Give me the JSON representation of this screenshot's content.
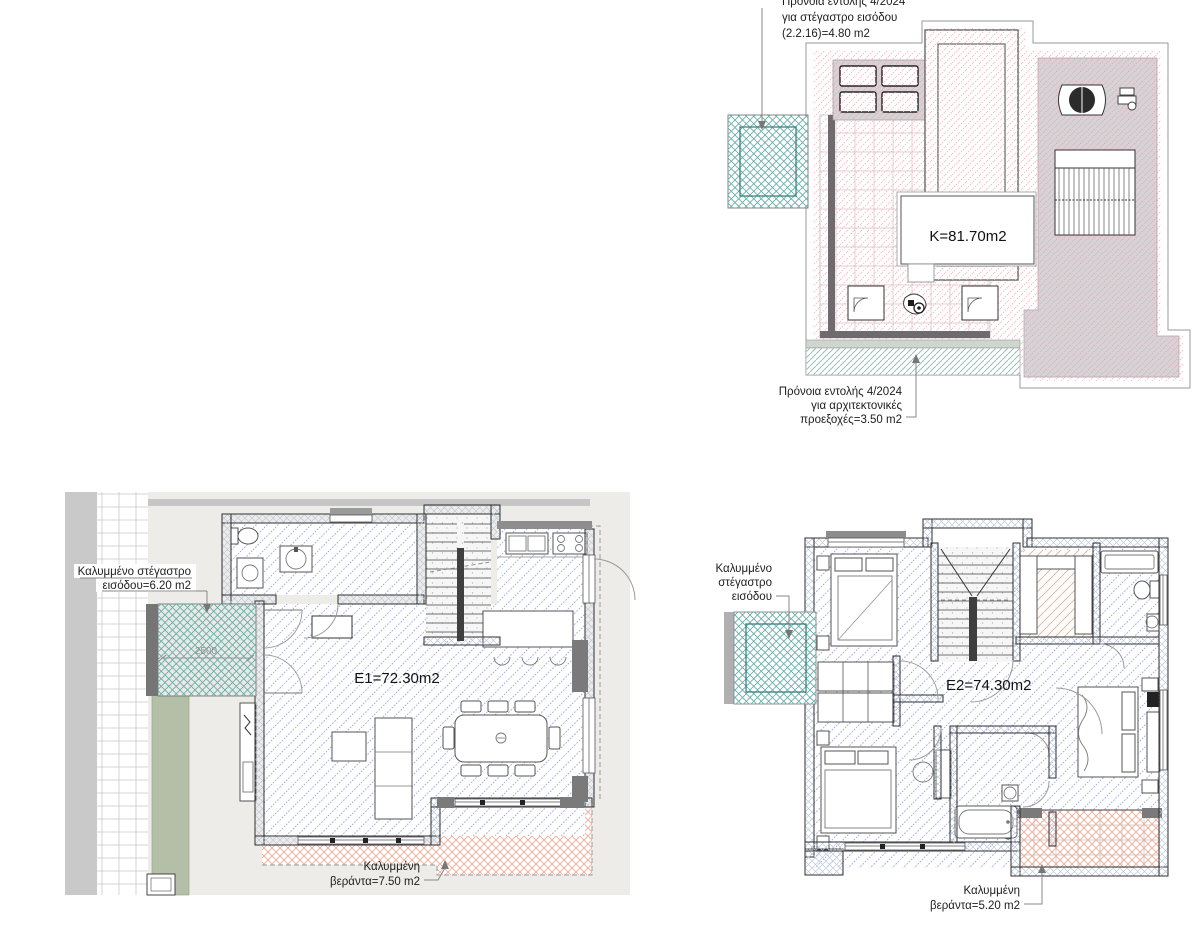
{
  "page": {
    "width": 1200,
    "height": 927,
    "background": "#ffffff",
    "type": "architectural-floor-plans"
  },
  "plans": {
    "roof": {
      "area_label": "K=81.70m2",
      "canopy_note": [
        "Πρόνοια εντολής 4/2024",
        "για στέγαστρο εισόδου",
        "(2.2.16)=4.80 m2"
      ],
      "projection_note": [
        "Πρόνοια εντολής 4/2024",
        "για αρχιτεκτονικές",
        "προεξοχές=3.50 m2"
      ]
    },
    "floor1": {
      "area_label": "E1=72.30m2",
      "canopy_note": [
        "Καλυμμένο στέγαστρο",
        "εισόδου=6.20 m2"
      ],
      "canopy_dimension": "2500",
      "veranda_note": [
        "Καλυμμένη",
        "βεράντα=7.50 m2"
      ]
    },
    "floor2": {
      "area_label": "E2=74.30m2",
      "canopy_note": [
        "Καλυμμένο",
        "στέγαστρο",
        "εισόδου"
      ],
      "veranda_note": [
        "Καλυμμένη",
        "βεράντα=5.20 m2"
      ]
    }
  },
  "colors": {
    "roof_hatch": "#f3bcc6",
    "roof_equipment_zone": "#d8d2d7",
    "floor_hatch": "#a9b1e2",
    "wall_hatch": "#bfcade",
    "canopy_hatch": "#62aba7",
    "veranda_hatch": "#eeab97",
    "site_background": "#edece8",
    "garden_strip": "#b3bfa7",
    "projection_strip_hatch": "#9cc0b8"
  }
}
